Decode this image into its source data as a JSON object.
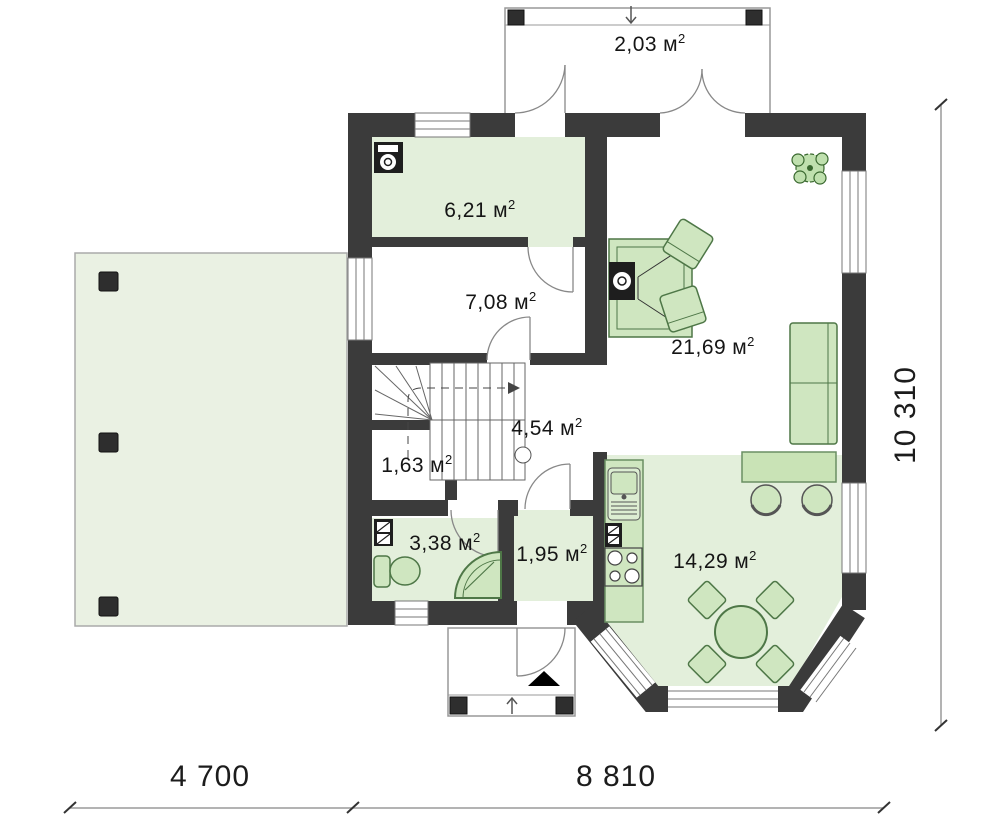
{
  "plan": {
    "unit": {
      "symbol": "м",
      "sup": "2"
    },
    "rooms": {
      "porch": {
        "area": "2,03"
      },
      "utility": {
        "area": "6,21"
      },
      "hallway": {
        "area": "7,08"
      },
      "stair_hall": {
        "area": "4,54"
      },
      "closet": {
        "area": "1,63"
      },
      "bathroom": {
        "area": "3,38"
      },
      "vestibule": {
        "area": "1,95"
      },
      "living_room": {
        "area": "21,69"
      },
      "kitchen_dining": {
        "area": "14,29"
      }
    },
    "dimensions": {
      "bottom_left": "4 700",
      "bottom_right": "8 810",
      "right_side": "10 310"
    },
    "colors": {
      "wall": "#3b3b3b",
      "room_fill": "#e3efdb",
      "terrace_fill": "#eaf1e3",
      "furniture_fill": "#cfe6c0",
      "furniture_stroke": "#4e7747",
      "outline": "#8f8f8f",
      "text": "#151515"
    }
  }
}
